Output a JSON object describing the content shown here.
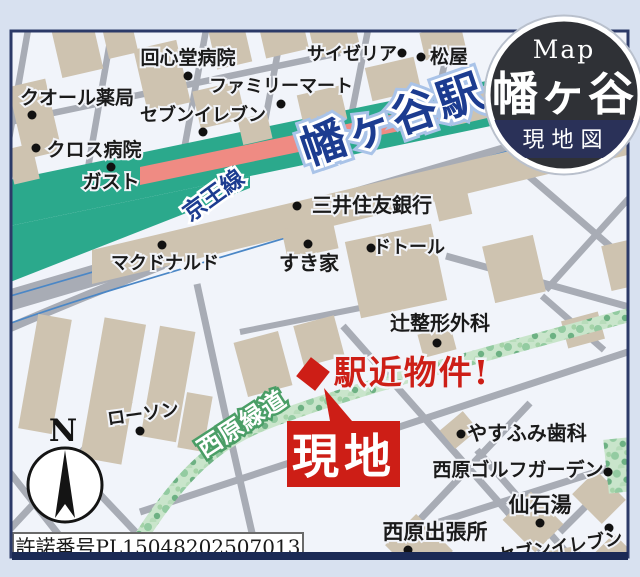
{
  "badge": {
    "subtitle_en": "Map",
    "title": "幡ヶ谷",
    "ribbon": "現地図"
  },
  "railway": {
    "line_name": "京王線",
    "station_name": "幡ヶ谷駅"
  },
  "greenway": {
    "name": "西原緑道"
  },
  "site": {
    "label": "現地",
    "catchphrase": "駅近物件!"
  },
  "compass": {
    "north": "N"
  },
  "license": {
    "number": "許諾番号PL15048202507013"
  },
  "pois": [
    {
      "name": "回心堂病院"
    },
    {
      "name": "サイゼリア"
    },
    {
      "name": "松屋"
    },
    {
      "name": "クオール薬局"
    },
    {
      "name": "ファミリーマート"
    },
    {
      "name": "セブンイレブン"
    },
    {
      "name": "クロス病院"
    },
    {
      "name": "ガスト"
    },
    {
      "name": "三井住友銀行"
    },
    {
      "name": "マクドナルド"
    },
    {
      "name": "すき家"
    },
    {
      "name": "ドトール"
    },
    {
      "name": "辻整形外科"
    },
    {
      "name": "ローソン"
    },
    {
      "name": "やすふみ歯科"
    },
    {
      "name": "西原ゴルフガーデン"
    },
    {
      "name": "仙石湯"
    },
    {
      "name": "西原出張所"
    },
    {
      "name": "セブンイレブン"
    }
  ],
  "colors": {
    "accent_red": "#cd1e16",
    "rail_teal": "#2ba98c",
    "platform_pink": "#ef8b83",
    "station_text_navy": "#1c3c90",
    "greenway_green": "#8cc49a",
    "badge_charcoal": "#2f3136",
    "badge_navy": "#2a3158",
    "road_gray": "#a8acb5",
    "building_tan": "#cec3b0",
    "frame_navy": "#2c3a68"
  }
}
